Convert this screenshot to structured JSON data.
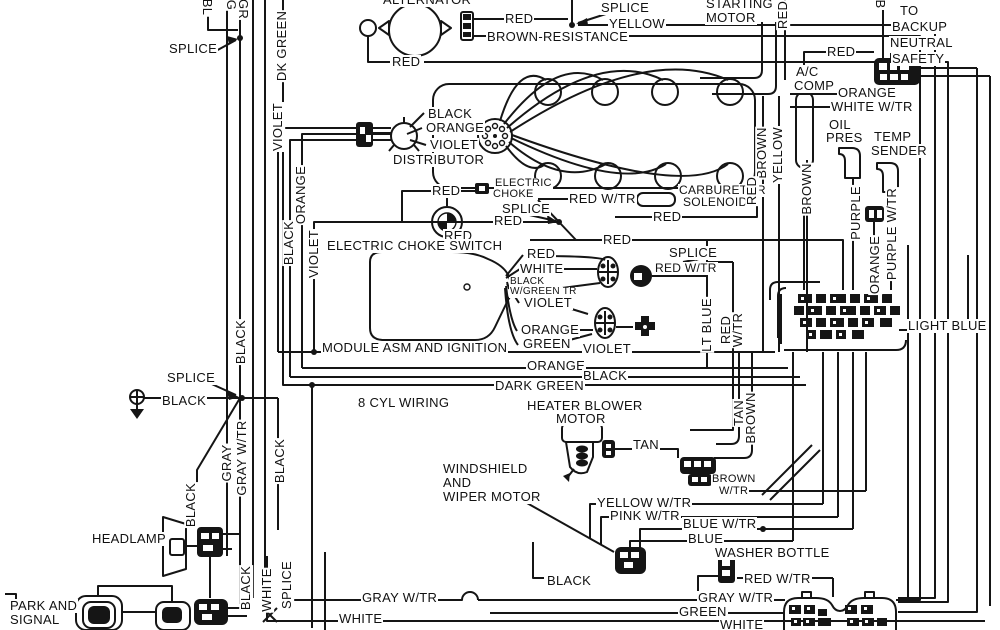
{
  "title": "8 CYL WIRING",
  "diagram": {
    "type": "automotive wiring diagram",
    "ink_color": "#151515",
    "background_color": "#ffffff",
    "symbols": [
      "alternator",
      "distributor",
      "spark-plugs",
      "engine-block",
      "module-asm-ignition",
      "electric-choke",
      "electric-choke-switch",
      "carburetor-solenoid",
      "heater-blower-motor",
      "windshield-wiper-connector",
      "washer-bottle-connector",
      "fuse-block",
      "bulkhead-connector",
      "headlamp",
      "park-and-signal-lamps",
      "ground",
      "backup-neutral-safety-connector",
      "ac-compressor",
      "oil-pressure-sender",
      "temp-sender",
      "starting-motor",
      "splice"
    ],
    "labels": [
      {
        "t": "SPLICE",
        "x": 168,
        "y": 42
      },
      {
        "t": "ALTERNATOR",
        "x": 382,
        "y": -7
      },
      {
        "t": "RED",
        "x": 504,
        "y": 12
      },
      {
        "t": "BROWN-RESISTANCE",
        "x": 486,
        "y": 30
      },
      {
        "t": "SPLICE",
        "x": 600,
        "y": 1
      },
      {
        "t": "YELLOW",
        "x": 608,
        "y": 17
      },
      {
        "t": "STARTING",
        "x": 705,
        "y": -3
      },
      {
        "t": "MOTOR",
        "x": 705,
        "y": 11
      },
      {
        "t": "TO",
        "x": 899,
        "y": 4
      },
      {
        "t": "BACKUP",
        "x": 891,
        "y": 20
      },
      {
        "t": "NEUTRAL",
        "x": 889,
        "y": 36
      },
      {
        "t": "SAFETY",
        "x": 891,
        "y": 52
      },
      {
        "t": "RED",
        "x": 826,
        "y": 45
      },
      {
        "t": "A/C",
        "x": 795,
        "y": 65
      },
      {
        "t": "COMP",
        "x": 793,
        "y": 79
      },
      {
        "t": "ORANGE",
        "x": 837,
        "y": 86
      },
      {
        "t": "WHITE W/TR",
        "x": 830,
        "y": 100
      },
      {
        "t": "OIL",
        "x": 828,
        "y": 118
      },
      {
        "t": "PRES",
        "x": 825,
        "y": 131
      },
      {
        "t": "TEMP",
        "x": 873,
        "y": 130
      },
      {
        "t": "SENDER",
        "x": 870,
        "y": 144
      },
      {
        "t": "RED",
        "x": 391,
        "y": 55
      },
      {
        "t": "BLACK",
        "x": 427,
        "y": 107
      },
      {
        "t": "ORANGE",
        "x": 425,
        "y": 121
      },
      {
        "t": "VIOLET",
        "x": 429,
        "y": 138
      },
      {
        "t": "DISTRIBUTOR",
        "x": 392,
        "y": 153
      },
      {
        "t": "RED",
        "x": 431,
        "y": 184
      },
      {
        "t": "ELECTRIC",
        "x": 494,
        "y": 178,
        "fs": 11
      },
      {
        "t": "CHOKE",
        "x": 492,
        "y": 189,
        "fs": 11
      },
      {
        "t": "SPLICE",
        "x": 501,
        "y": 202
      },
      {
        "t": "RED",
        "x": 493,
        "y": 214
      },
      {
        "t": "RED W/TR",
        "x": 568,
        "y": 192
      },
      {
        "t": "CARBURETOR",
        "x": 678,
        "y": 184,
        "fs": 12
      },
      {
        "t": "SOLENOID",
        "x": 682,
        "y": 196,
        "fs": 12
      },
      {
        "t": "RED",
        "x": 652,
        "y": 210
      },
      {
        "t": "RED",
        "x": 443,
        "y": 229
      },
      {
        "t": "RED",
        "x": 602,
        "y": 233
      },
      {
        "t": "SPLICE",
        "x": 668,
        "y": 246
      },
      {
        "t": "RED W/TR",
        "x": 654,
        "y": 262,
        "fs": 12
      },
      {
        "t": "ELECTRIC CHOKE SWITCH",
        "x": 326,
        "y": 239
      },
      {
        "t": "RED",
        "x": 526,
        "y": 247
      },
      {
        "t": "WHITE",
        "x": 519,
        "y": 262
      },
      {
        "t": "BLACK",
        "x": 509,
        "y": 277,
        "fs": 10
      },
      {
        "t": "W/GREEN TR",
        "x": 509,
        "y": 287,
        "fs": 10
      },
      {
        "t": "VIOLET",
        "x": 523,
        "y": 296
      },
      {
        "t": "ORANGE",
        "x": 520,
        "y": 323
      },
      {
        "t": "GREEN",
        "x": 522,
        "y": 337
      },
      {
        "t": "MODULE ASM AND IGNITION",
        "x": 321,
        "y": 341
      },
      {
        "t": "VIOLET",
        "x": 582,
        "y": 342
      },
      {
        "t": "ORANGE",
        "x": 526,
        "y": 359
      },
      {
        "t": "BLACK",
        "x": 582,
        "y": 369
      },
      {
        "t": "DARK GREEN",
        "x": 494,
        "y": 379
      },
      {
        "t": "8 CYL WIRING",
        "x": 357,
        "y": 396
      },
      {
        "t": "SPLICE",
        "x": 166,
        "y": 371
      },
      {
        "t": "BLACK",
        "x": 161,
        "y": 394
      },
      {
        "t": "HEATER BLOWER",
        "x": 526,
        "y": 399
      },
      {
        "t": "MOTOR",
        "x": 555,
        "y": 412
      },
      {
        "t": "TAN",
        "x": 632,
        "y": 438
      },
      {
        "t": "WINDSHIELD",
        "x": 442,
        "y": 462
      },
      {
        "t": "AND",
        "x": 442,
        "y": 476
      },
      {
        "t": "WIPER MOTOR",
        "x": 442,
        "y": 490
      },
      {
        "t": "BROWN",
        "x": 711,
        "y": 474,
        "fs": 11
      },
      {
        "t": "W/TR",
        "x": 718,
        "y": 486,
        "fs": 11
      },
      {
        "t": "YELLOW W/TR",
        "x": 596,
        "y": 496
      },
      {
        "t": "PINK W/TR",
        "x": 609,
        "y": 509
      },
      {
        "t": "BLUE W/TR",
        "x": 682,
        "y": 517
      },
      {
        "t": "BLUE",
        "x": 687,
        "y": 532
      },
      {
        "t": "WASHER BOTTLE",
        "x": 714,
        "y": 546
      },
      {
        "t": "RED W/TR",
        "x": 743,
        "y": 572
      },
      {
        "t": "GRAY W/TR",
        "x": 697,
        "y": 591
      },
      {
        "t": "GREEN",
        "x": 678,
        "y": 605
      },
      {
        "t": "WHITE",
        "x": 719,
        "y": 618
      },
      {
        "t": "GRAY W/TR",
        "x": 361,
        "y": 591
      },
      {
        "t": "WHITE",
        "x": 338,
        "y": 612
      },
      {
        "t": "BLACK",
        "x": 546,
        "y": 574
      },
      {
        "t": "HEADLAMP",
        "x": 91,
        "y": 532
      },
      {
        "t": "PARK AND",
        "x": 9,
        "y": 599
      },
      {
        "t": "SIGNAL",
        "x": 9,
        "y": 613
      },
      {
        "t": "LIGHT BLUE",
        "x": 907,
        "y": 319
      },
      {
        "t": "BL",
        "x": 207,
        "y": 7,
        "r": 90
      },
      {
        "t": "G",
        "x": 231,
        "y": 5,
        "r": 90
      },
      {
        "t": "GR",
        "x": 243,
        "y": 9,
        "r": 90
      },
      {
        "t": "DK GREEN",
        "x": 282,
        "y": 46,
        "r": -90
      },
      {
        "t": "RED",
        "x": 783,
        "y": 15,
        "r": -90
      },
      {
        "t": "B",
        "x": 880,
        "y": 4,
        "r": 90
      },
      {
        "t": "BROWN",
        "x": 762,
        "y": 153,
        "r": -90
      },
      {
        "t": "YELLOW",
        "x": 778,
        "y": 155,
        "r": -90
      },
      {
        "t": "RED",
        "x": 752,
        "y": 191,
        "r": -90
      },
      {
        "t": "BROWN",
        "x": 807,
        "y": 189,
        "r": -90
      },
      {
        "t": "PURPLE",
        "x": 856,
        "y": 213,
        "r": -90
      },
      {
        "t": "PURPLE W/TR",
        "x": 892,
        "y": 234,
        "r": -90
      },
      {
        "t": "ORANGE",
        "x": 875,
        "y": 265,
        "r": -90
      },
      {
        "t": "VIOLET",
        "x": 278,
        "y": 127,
        "r": -90
      },
      {
        "t": "ORANGE",
        "x": 301,
        "y": 195,
        "r": -90
      },
      {
        "t": "BLACK",
        "x": 289,
        "y": 243,
        "r": -90
      },
      {
        "t": "VIOLET",
        "x": 314,
        "y": 254,
        "r": -90
      },
      {
        "t": "BLACK",
        "x": 241,
        "y": 342,
        "r": -90
      },
      {
        "t": "GRAY",
        "x": 227,
        "y": 463,
        "r": -90
      },
      {
        "t": "GRAY W/TR",
        "x": 242,
        "y": 458,
        "r": -90
      },
      {
        "t": "BLACK",
        "x": 280,
        "y": 461,
        "r": -90
      },
      {
        "t": "BLACK",
        "x": 191,
        "y": 505,
        "r": -90
      },
      {
        "t": "LT BLUE",
        "x": 707,
        "y": 325,
        "r": -90
      },
      {
        "t": "RED",
        "x": 726,
        "y": 330,
        "r": -90
      },
      {
        "t": "W/TR",
        "x": 738,
        "y": 330,
        "r": -90
      },
      {
        "t": "TAN",
        "x": 739,
        "y": 413,
        "r": -90
      },
      {
        "t": "BROWN",
        "x": 751,
        "y": 418,
        "r": -90
      },
      {
        "t": "BLACK",
        "x": 246,
        "y": 588,
        "r": -90
      },
      {
        "t": "WHITE",
        "x": 267,
        "y": 590,
        "r": -90
      },
      {
        "t": "SPLICE",
        "x": 287,
        "y": 585,
        "r": -90
      }
    ]
  }
}
